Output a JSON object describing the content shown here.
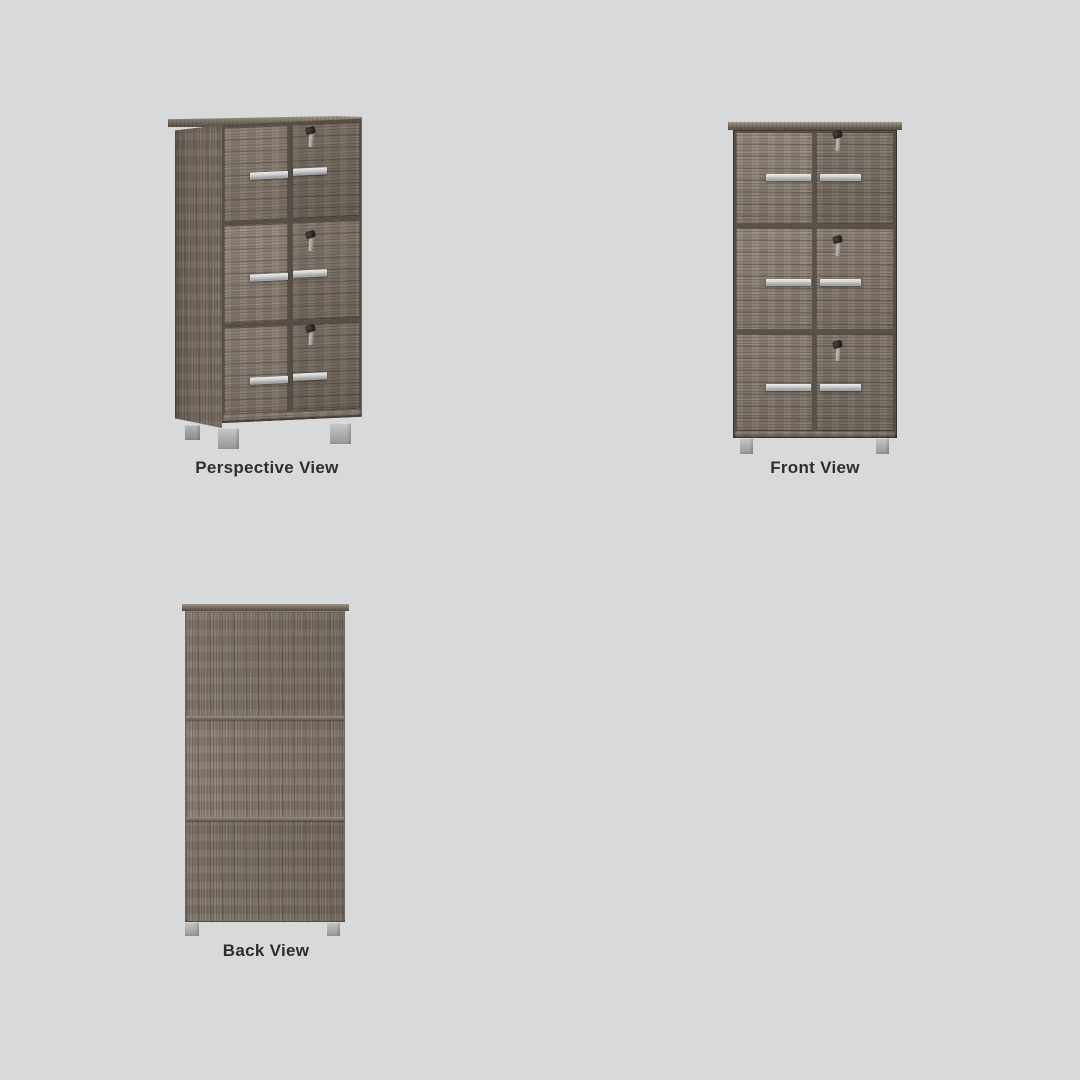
{
  "canvas": {
    "background_color": "#d8d9da"
  },
  "views": [
    {
      "id": "perspective",
      "label": "Perspective View"
    },
    {
      "id": "front",
      "label": "Front View"
    },
    {
      "id": "back",
      "label": "Back View"
    }
  ],
  "subject": {
    "description": "Tall six-door wooden locker cabinet, dark taupe oak finish, silver bar handles, keys hanging in right-door locks, silver square feet",
    "rows": 3,
    "columns": 2,
    "doors_per_front_view": 6,
    "keys_visible_per_front_view": 3
  },
  "colors": {
    "bg": "#d8d9da",
    "label": "#2f2d2e",
    "wood-mid": "#81756a",
    "wood-dark": "#5a5047",
    "handle-silver": "#c7c8c9",
    "feet-silver": "#b0b1b3",
    "key-dark": "#26221f",
    "key-shaft": "#b6b2ac"
  }
}
